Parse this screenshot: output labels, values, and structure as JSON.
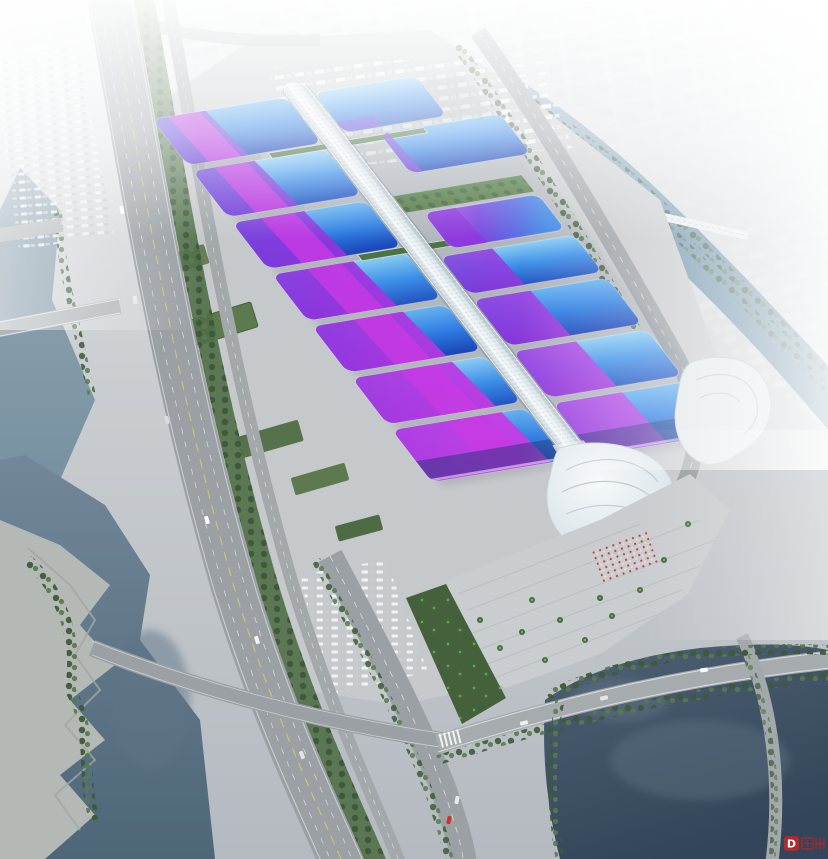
{
  "image": {
    "alt": "Aerial rendering of a large exhibition and convention center: rows of blue wave-form hall roofs crossed by diagonal purple ribbons, joined by a white central ribbon concourse ending in a shell-shaped south lobby and palm-lined plaza, surrounded by highways, tree-lined boulevards, canals, dark lakes and a hazy white city skyline."
  },
  "watermark": {
    "text": "D"
  },
  "palette": {
    "hall-blue-light": "#66b2f0",
    "hall-blue": "#2e7ce2",
    "hall-blue-deep": "#1b44b6",
    "ribbon-violet": "#5946d6",
    "ribbon-purple": "#9632de",
    "ribbon-magenta": "#c83ae4",
    "spine-white": "#f4f8fa",
    "apron-gray": "#c6c9cb",
    "road-gray": "#9aa0a4",
    "tree-green": "#3e5a39",
    "lawn-green": "#587a4e",
    "water-river": "#76909f",
    "water-lake": "#33455a",
    "water-canal": "#567e9a",
    "crowd-red": "#cf3326",
    "haze-white": "#ffffff",
    "watermark-red": "#cc2222"
  }
}
